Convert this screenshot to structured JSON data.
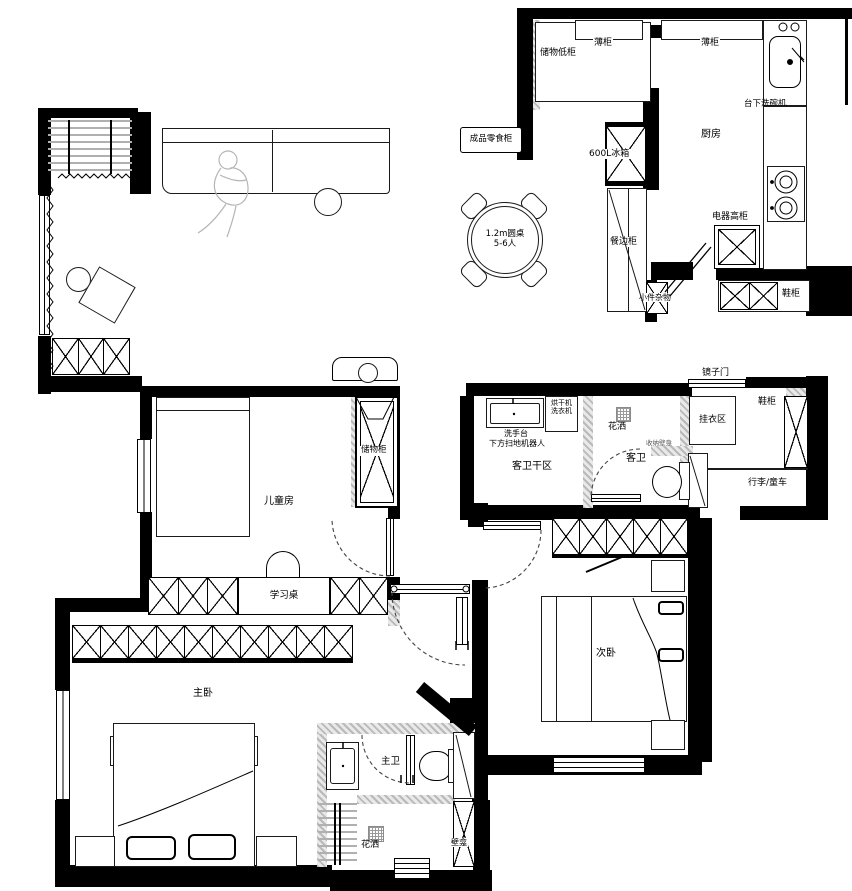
{
  "colors": {
    "wall": "#000000",
    "hatch_wall": "#b9b9b9",
    "line": "#1a1a1a",
    "figure": "#b5b5b5"
  },
  "labels": {
    "kitchen": {
      "room": "厨房",
      "storage_low_cabinet": "储物低柜",
      "thin_cabinet_1": "薄柜",
      "thin_cabinet_2": "薄柜",
      "under_counter_dishwasher": "台下洗碗机",
      "appliance_tall_cabinet": "电器高柜",
      "fridge": "600L冰箱",
      "shoe_cabinet": "鞋柜"
    },
    "dining": {
      "snack_cabinet": "成品零食柜",
      "sideboard": "餐边柜",
      "round_table_line1": "1.2m圆桌",
      "round_table_line2": "5-6人",
      "small_misc": "小件杂物"
    },
    "entry": {
      "mirror_door": "镜子门",
      "hanging_area": "挂衣区",
      "shoe_cabinet": "鞋柜",
      "luggage_stroller": "行李/童车"
    },
    "guest_bath": {
      "dry_area": "客卫干区",
      "room": "客卫",
      "dryer": "烘干机",
      "washer": "洗衣机",
      "wash_basin": "洗手台",
      "robot_vacuum_below": "下方扫地机器人",
      "shower": "花洒",
      "niche": "收纳壁龛"
    },
    "kids_room": {
      "room": "儿童房",
      "storage_cabinet": "储物柜",
      "study_desk": "学习桌"
    },
    "master_room": {
      "room": "主卧"
    },
    "master_bath": {
      "room": "主卫",
      "shower": "花洒",
      "niche": "壁龛"
    },
    "second_room": {
      "room": "次卧"
    }
  }
}
